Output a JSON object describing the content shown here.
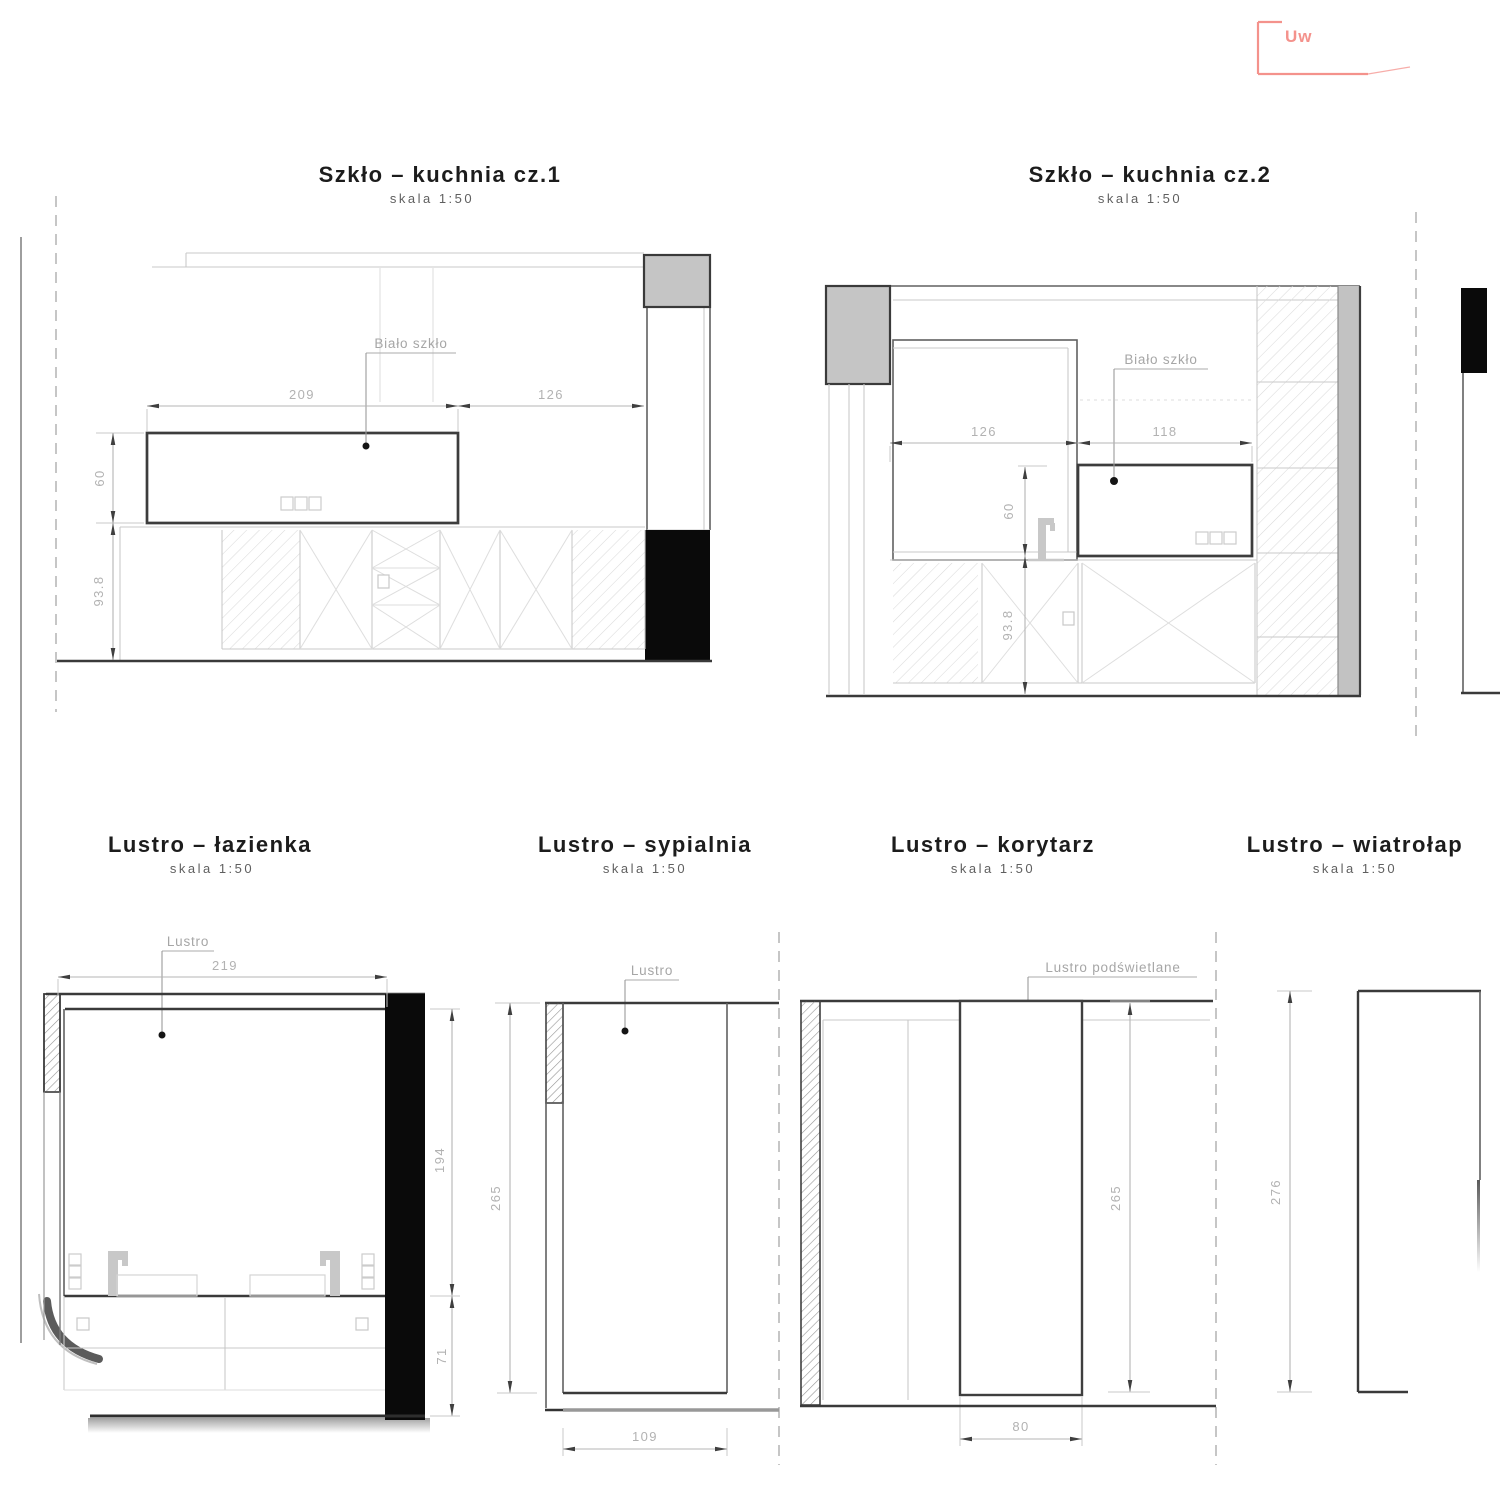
{
  "canvas": {
    "background": "#ffffff",
    "accent_red": "#f4928c"
  },
  "stamp": {
    "text": "Uw"
  },
  "kuchnia1": {
    "title": "Szkło – kuchnia cz.1",
    "scale": "skala 1:50",
    "label": "Biało szkło",
    "dim_top_left": "209",
    "dim_top_right": "126",
    "dim_height": "60",
    "dim_floor": "93.8"
  },
  "kuchnia2": {
    "title": "Szkło – kuchnia cz.2",
    "scale": "skala 1:50",
    "label": "Biało szkło",
    "dim_top_left": "126",
    "dim_top_right": "118",
    "dim_height": "60",
    "dim_floor": "93.8"
  },
  "lazienka": {
    "title": "Lustro – łazienka",
    "scale": "skala 1:50",
    "label": "Lustro",
    "dim_width": "219",
    "dim_height": "194",
    "dim_below": "71"
  },
  "sypialnia": {
    "title": "Lustro – sypialnia",
    "scale": "skala 1:50",
    "label": "Lustro",
    "dim_height": "265",
    "dim_width": "109"
  },
  "korytarz": {
    "title": "Lustro – korytarz",
    "scale": "skala 1:50",
    "label": "Lustro podświetlane",
    "dim_height": "265",
    "dim_width": "80"
  },
  "wiatrolap": {
    "title": "Lustro – wiatrołap",
    "scale": "skala 1:50",
    "dim_height": "276"
  }
}
